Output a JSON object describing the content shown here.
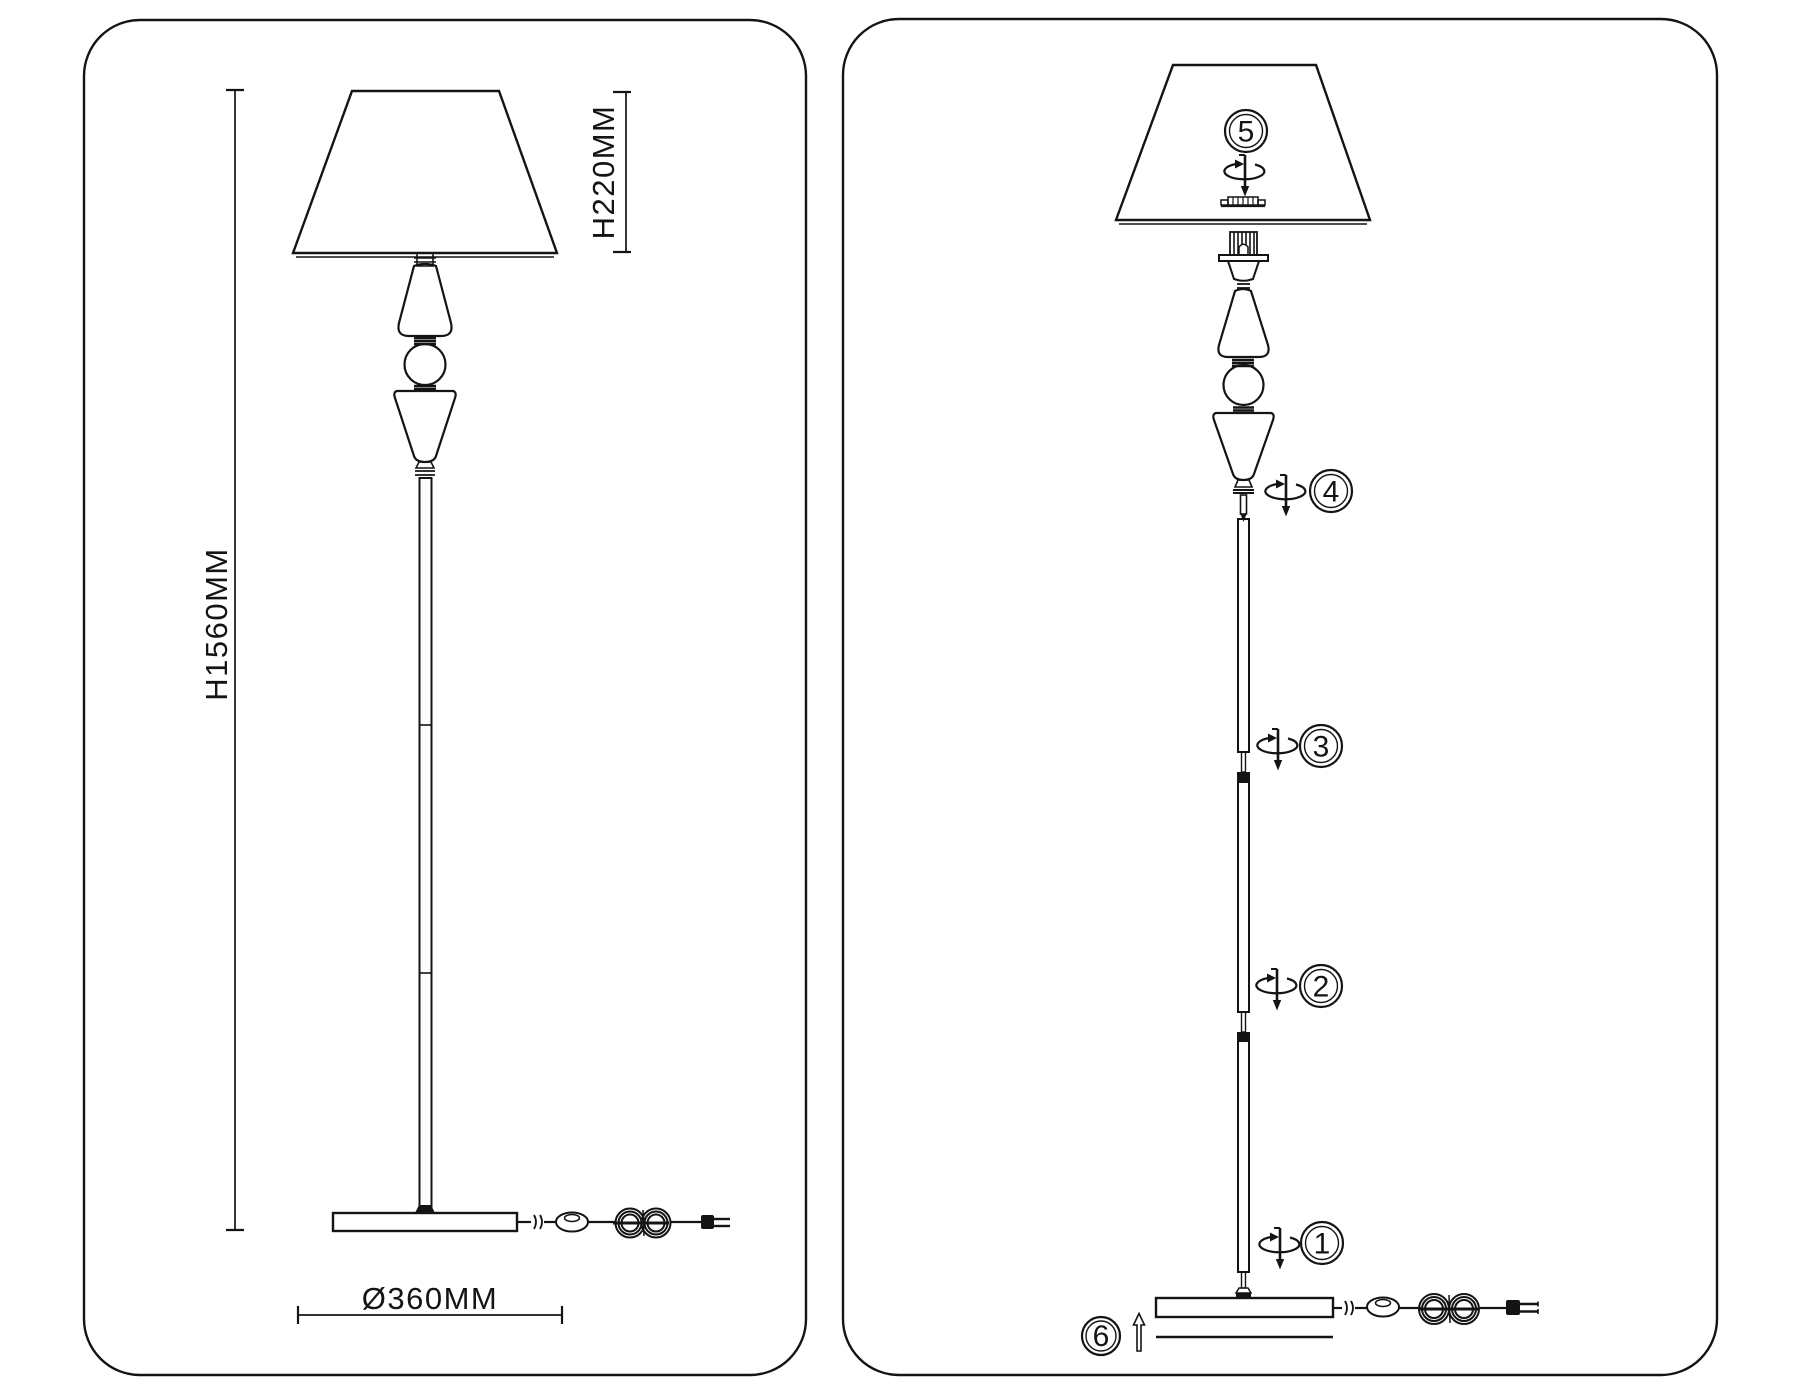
{
  "colors": {
    "background": "#ffffff",
    "line": "#141414"
  },
  "left_panel": {
    "description_dimensions": {
      "height": "H1560MM",
      "shade_height": "H220MM",
      "base_diameter": "Ø360MM"
    }
  },
  "right_panel": {
    "steps": [
      {
        "number": "1"
      },
      {
        "number": "2"
      },
      {
        "number": "3"
      },
      {
        "number": "4"
      },
      {
        "number": "5"
      },
      {
        "number": "6"
      }
    ]
  },
  "icons": {
    "rotate-screw-icon": "elliptical circular arrow with downward screw pin",
    "up-arrow-icon": "outline arrow pointing up",
    "power-switch-icon": "inline oval cord switch",
    "cord-coil-icon": "figure-eight coiled power cord",
    "power-plug-icon": "two-prong plug"
  }
}
